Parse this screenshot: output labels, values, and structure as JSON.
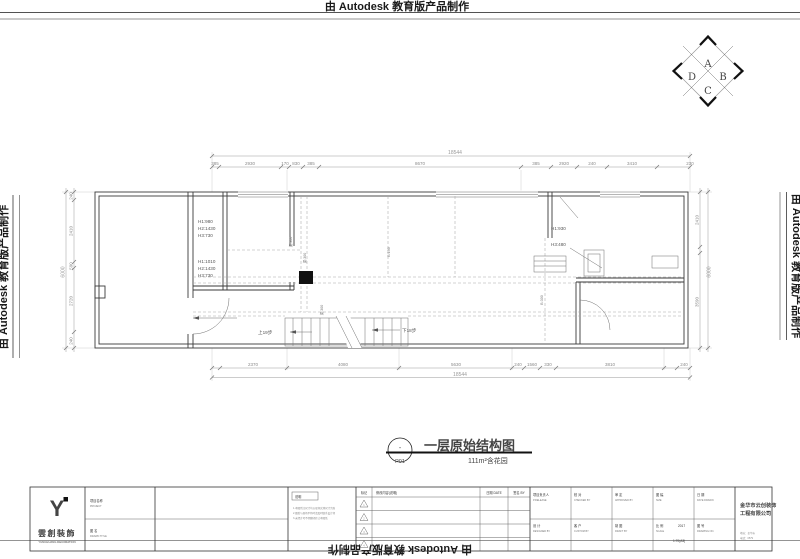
{
  "watermark": {
    "top": "由 Autodesk 教育版产品制作",
    "bottom": "由 Autodesk 教育版产品制作",
    "left": "由 Autodesk 教育版产品制作",
    "right": "由 Autodesk 教育版产品制作"
  },
  "compass": {
    "a": "A",
    "b": "B",
    "c": "C",
    "d": "D"
  },
  "dims": {
    "top_total": "18544",
    "bottom_total": "18544",
    "left_total": "6000",
    "right_total": "6000",
    "top": [
      "385",
      "2930",
      "170",
      "830",
      "385",
      "8670",
      "385",
      "2920",
      "240",
      "3410",
      "230"
    ],
    "bottom": [
      "2370",
      "4080",
      "5630",
      "240",
      "1560",
      "330",
      "3810",
      "240"
    ],
    "left": [
      "240",
      "2410",
      "590",
      "2720",
      "240"
    ],
    "right": [
      "2410",
      "3590"
    ]
  },
  "annotations": {
    "room1": [
      "H1:980",
      "H2:1430",
      "H3:730"
    ],
    "room2": [
      "H1:1010",
      "H2:1430",
      "H3:730"
    ],
    "right_wall": [
      "H1:930",
      "H3:480"
    ],
    "beams": [
      "梁:300",
      "梁:300",
      "B:190",
      "梁:300",
      "B:300"
    ],
    "stairs_up": "上19步",
    "stairs_down": "下18步"
  },
  "title": {
    "bubble_top": "-",
    "bubble_code": "P01",
    "name": "一层原始结构图",
    "area": "111m²含花园"
  },
  "titleblock": {
    "logo_mark": "Y",
    "logo_cn": "雲創裝飾",
    "logo_en": "YUNCHUANG DECORATION",
    "project_label": "项目名称",
    "project_en": "PROJECT",
    "drawing_label": "图 名",
    "drawing_en": "DRAWN TITLE",
    "notes_title": "说明",
    "notes": [
      "1.本图所注尺寸均以现场实测尺寸为准",
      "2.图纸与现场不符时请及时联系设计师",
      "3.未经许可不得翻印转让本图纸"
    ],
    "rev": {
      "mark": "标记",
      "content": "修改内容(说明)",
      "date": "日期 DATE",
      "by": "签名 BY",
      "rows": [
        "1",
        "2",
        "3",
        "4"
      ]
    },
    "fields": {
      "r1c1": {
        "cn": "项目负责人",
        "en": "P.RELEASE"
      },
      "r1c2": {
        "cn": "校 对",
        "en": "CHECKED BY"
      },
      "r1c3": {
        "cn": "审 定",
        "en": "APPROVED BY"
      },
      "r1c4": {
        "cn": "图 幅",
        "en": "SIZE"
      },
      "r1c5": {
        "cn": "日 期",
        "en": "DATE DRAWN"
      },
      "r2c1": {
        "cn": "设 计",
        "en": "DESIGNED BY"
      },
      "r2c2": {
        "cn": "客 户",
        "en": "CUSTOM BY"
      },
      "r2c3": {
        "cn": "制 图",
        "en": "DRAFT BY"
      },
      "r2c4": {
        "cn": "比 例",
        "en": "SCALE",
        "v1": "2017",
        "v2": "1:70(A3)"
      },
      "r2c5": {
        "cn": "图 号",
        "en": "DRAWING NO."
      }
    },
    "company": {
      "name1": "金华市云创装饰",
      "name2": "工程有限公司",
      "addr": "地址：金华市",
      "tel": "电话：0579"
    }
  }
}
